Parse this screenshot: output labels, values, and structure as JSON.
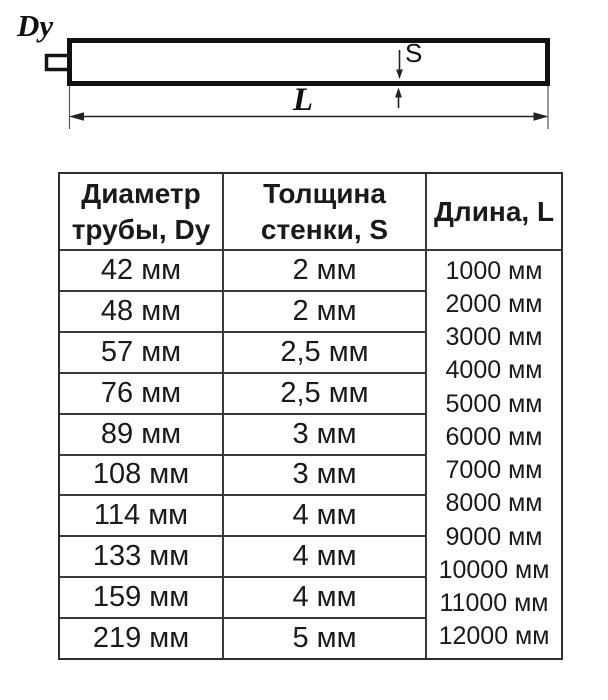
{
  "diagram": {
    "pipe_diameter_label": "Dy",
    "wall_thickness_label": "S",
    "length_label": "L"
  },
  "table": {
    "header": {
      "col1": [
        "Диаметр",
        "трубы, Dy"
      ],
      "col2": [
        "Толщина",
        "стенки, S"
      ],
      "col3": "Длина, L"
    },
    "rows": [
      [
        "42 мм",
        "2 мм"
      ],
      [
        "48 мм",
        "2 мм"
      ],
      [
        "57 мм",
        "2,5 мм"
      ],
      [
        "76 мм",
        "2,5 мм"
      ],
      [
        "89 мм",
        "3 мм"
      ],
      [
        "108 мм",
        "3 мм"
      ],
      [
        "114 мм",
        "4 мм"
      ],
      [
        "133 мм",
        "4 мм"
      ],
      [
        "159 мм",
        "4 мм"
      ],
      [
        "219 мм",
        "5 мм"
      ]
    ],
    "lengths": [
      "1000 мм",
      "2000 мм",
      "3000 мм",
      "4000 мм",
      "5000 мм",
      "6000 мм",
      "7000 мм",
      "8000 мм",
      "9000 мм",
      "10000 мм",
      "11000 мм",
      "12000 мм"
    ]
  },
  "colors": {
    "ink": "#1a1a1a",
    "grid_line": "#3a3a3a",
    "drawing_stroke": "#111111"
  }
}
